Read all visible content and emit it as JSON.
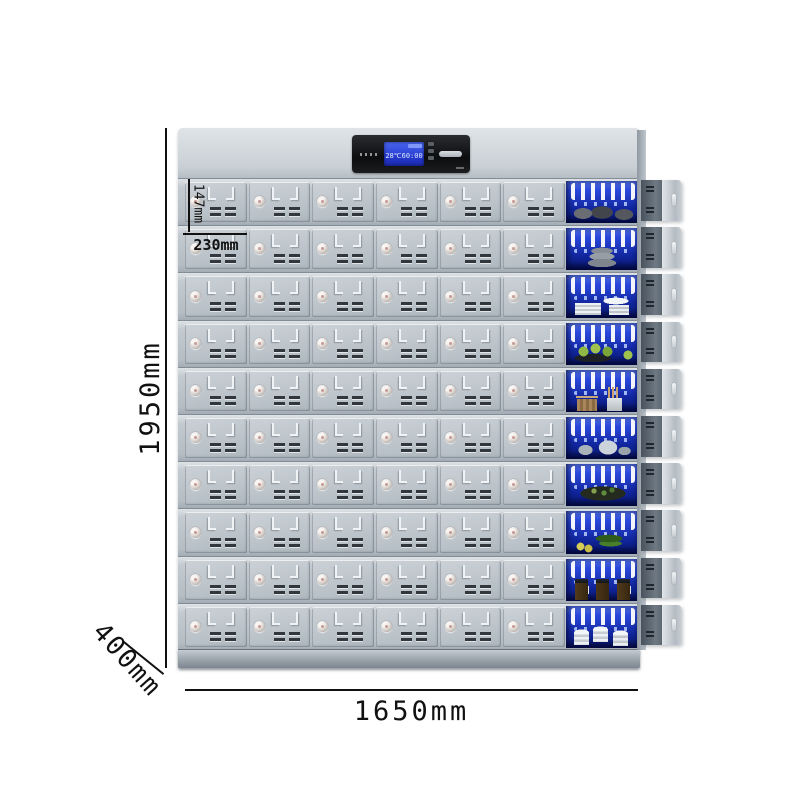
{
  "product": {
    "name": "commercial-disinfection-cabinet",
    "rows_note": "10 rows x 6 lockable doors, right column shown open with UV-lit compartments"
  },
  "dimensions": {
    "height": "1950mm",
    "width": "1650mm",
    "depth": "400mm",
    "cell_height": "147mm",
    "cell_width": "230mm"
  },
  "display": {
    "temperature": "28℃",
    "time": "60:00"
  },
  "cabinet": {
    "rows": 10,
    "doors_per_row": 6,
    "door_features": [
      "lock-icon",
      "handle-recess",
      "vent-slots"
    ],
    "row_contents": [
      {
        "kind": "dark-bowls"
      },
      {
        "kind": "gray-bowls"
      },
      {
        "kind": "white-plates"
      },
      {
        "kind": "green-fruits"
      },
      {
        "kind": "utensils"
      },
      {
        "kind": "silver-teapots"
      },
      {
        "kind": "dark-platter"
      },
      {
        "kind": "green-vegetables"
      },
      {
        "kind": "pickle-jars"
      },
      {
        "kind": "white-bowl-stacks"
      }
    ],
    "colors": {
      "body_light": "#d9dee2",
      "body_mid": "#b7bfc6",
      "uv_blue_top": "#5b7bf5",
      "uv_blue_bottom": "#0a1b7d",
      "lcd_blue": "#2a48dd",
      "panel_black": "#0c0d0f"
    }
  }
}
